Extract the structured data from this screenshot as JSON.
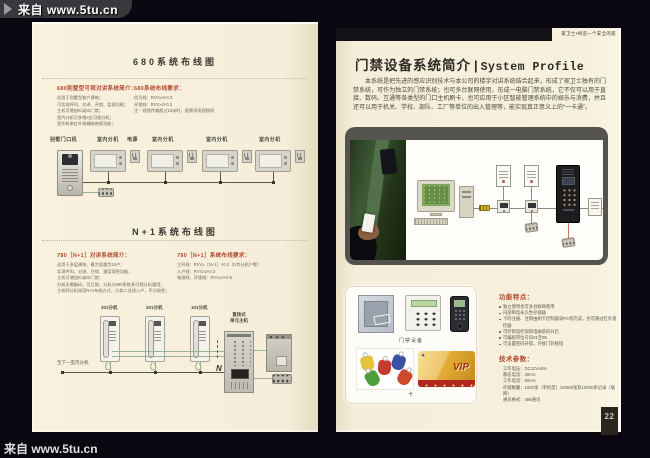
{
  "watermark": {
    "top": "来自 www.5tu.cn",
    "bottom": "来自 www.5tu.cn"
  },
  "colors": {
    "page_cream": "#f6eeda",
    "accent_red": "#b4492f",
    "background": "#0a0710",
    "photo_frame": "#55534d"
  },
  "left": {
    "s680": {
      "title": "680系统布线图",
      "intro_title": "680别墅型可视对讲系统简介：",
      "intro_lines": [
        "适用于别墅型独户建筑；",
        "可实现呼叫、对讲、开锁、监视功能；",
        "主机可增加IC或ID门禁；",
        "室内分机可多增4台可视分机；",
        "室外机带红外线辅助夜视功能；"
      ],
      "wiring_title": "680系统布线要求：",
      "wiring_lines": [
        "信号线：RVV≥4×0.3",
        "开锁线：RVV≥2×0.3",
        "注：视频传输超过15米时，视频采用视频线"
      ],
      "labels": [
        "别墅门口机",
        "室内分机",
        "电源",
        "室内分机",
        "室内分机",
        "室内分机"
      ]
    },
    "n1": {
      "title": "N+1系统布线图",
      "intro_title": "780［N+1］对讲系统简介：",
      "intro_lines": [
        "适用于多层建筑，最大容量为24户；",
        "实现呼叫、对讲、开锁、通话保密功能；",
        "主机可增加IC或ID门禁；",
        "分机无需编码，可互换，分机与680系统多可视分机通用；",
        "主机到分机采用N+1布线方式，分机二总线入户，不分极性；"
      ],
      "wiring_title": "780［N+1］系统布线要求：",
      "wiring_lines": [
        "主杆线：RVV≥［N+1］×0.3［N为分机户数］",
        "入户线：RVV≥2×0.3",
        "电源线、开锁线：RVV≥2×0.5"
      ],
      "handsets": [
        "301分机",
        "201分机",
        "101分机"
      ],
      "main_unit_l1": "直按式",
      "main_unit_l2": "单元主机",
      "bus_note": "至下一室内分机",
      "n_label": "N"
    }
  },
  "right": {
    "slogan": "家卫士•缔造一个安全的家",
    "title_cn": "门禁设备系统简介",
    "title_divider": "|",
    "title_en": "System Profile",
    "paragraph": "本系统是把先进的感应识别技术与本公司的楼宇对讲系统结合起来，形成了家卫士独有的门禁系统，可作为独立的门禁系统；也可多台联网使用，形成一电脑门禁系统，它不仅可以用于直接、数码、互通等各类型的门口主机刷卡，也可应用于小区智能管理系统中的娱乐与消费，并且还可以用于机关、学校、部队、工厂等单位的出入管理等，能实现真正意义上的“一卡通”。",
    "device_caption": "门禁设备",
    "card_caption": "卡",
    "card_logo": "✦",
    "vip_text": "VIP",
    "features_title": "功能特点：",
    "features": [
      "独立使用也可多台联网使用",
      "内部断电永久性存储器",
      "卡的注册、注销由刷卡控制器或PC机完成，也可通过红外遥控器",
      "可控制电控锁和电磁锁的开启",
      "可编程带位号码01至99",
      "可设置密码开锁，外接门铃按钮"
    ],
    "specs_title": "技术参数：",
    "specs": [
      "工作电压：DC12V±5%",
      "静态电流：30mA",
      "工作电流：50mA",
      "存储数量：1000张（单机型）/10000张及10000条记录（联网）",
      "通讯格式：485通讯"
    ],
    "page_number": "22"
  }
}
